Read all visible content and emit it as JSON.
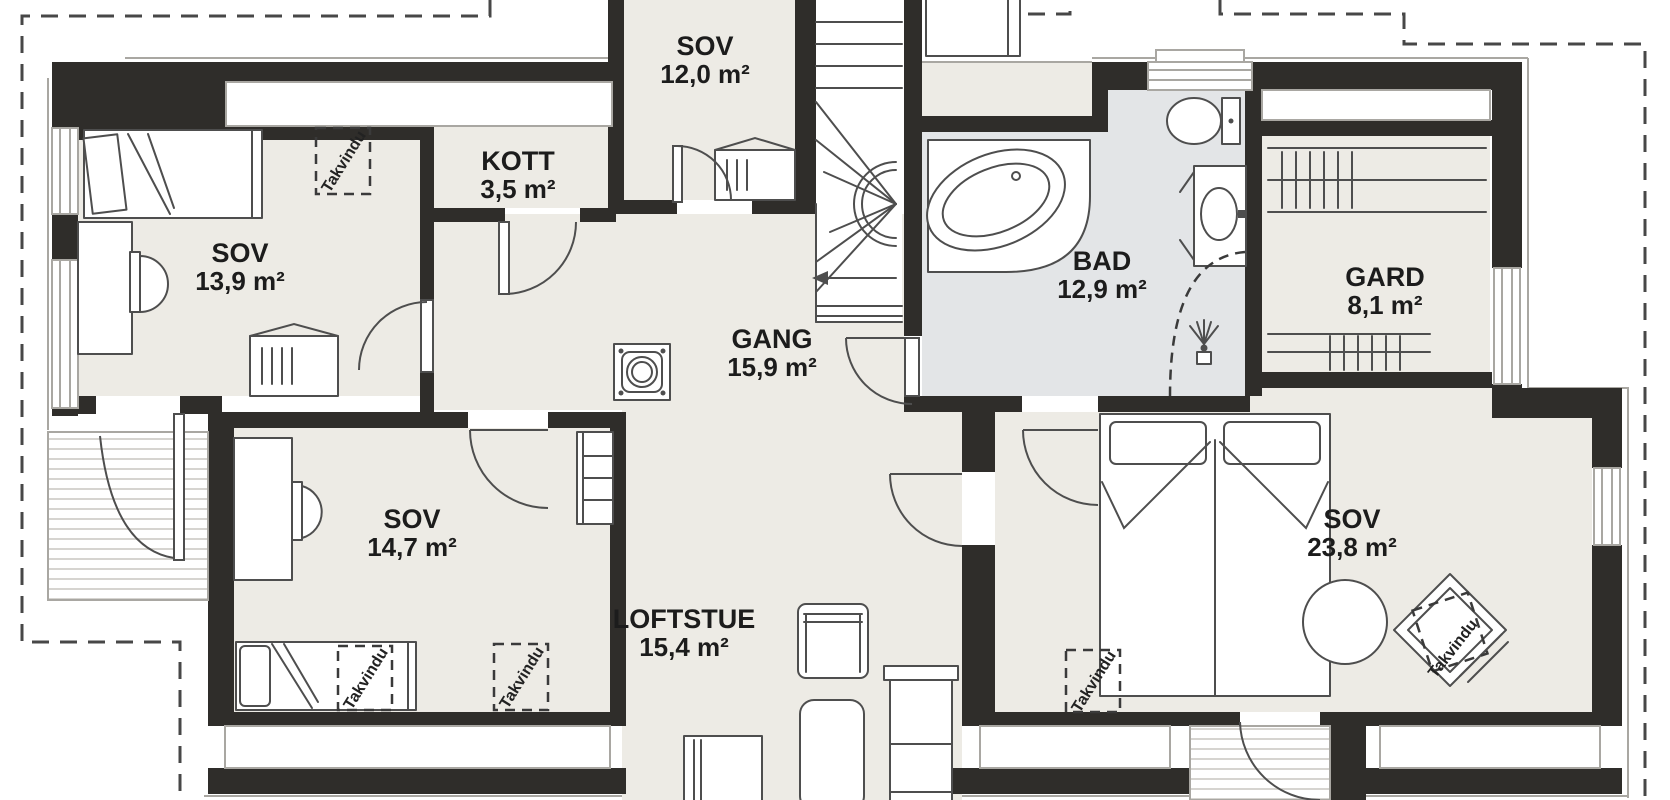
{
  "palette": {
    "wall": "#2f2d2a",
    "room_fill": "#edebe5",
    "bath_fill": "#e3e5e7",
    "background": "#ffffff",
    "line": "#4e4e4e",
    "outline": "#a9a7a2"
  },
  "labels": {
    "skylight": "Takvindu"
  },
  "rooms": [
    {
      "id": "sov-12",
      "name": "SOV",
      "area": "12,0 m²"
    },
    {
      "id": "kott",
      "name": "KOTT",
      "area": "3,5 m²"
    },
    {
      "id": "sov-13-9",
      "name": "SOV",
      "area": "13,9 m²"
    },
    {
      "id": "gang",
      "name": "GANG",
      "area": "15,9 m²"
    },
    {
      "id": "bad",
      "name": "BAD",
      "area": "12,9 m²"
    },
    {
      "id": "gard",
      "name": "GARD",
      "area": "8,1 m²"
    },
    {
      "id": "sov-14-7",
      "name": "SOV",
      "area": "14,7 m²"
    },
    {
      "id": "loftstue",
      "name": "LOFTSTUE",
      "area": "15,4 m²"
    },
    {
      "id": "sov-23-8",
      "name": "SOV",
      "area": "23,8 m²"
    }
  ]
}
